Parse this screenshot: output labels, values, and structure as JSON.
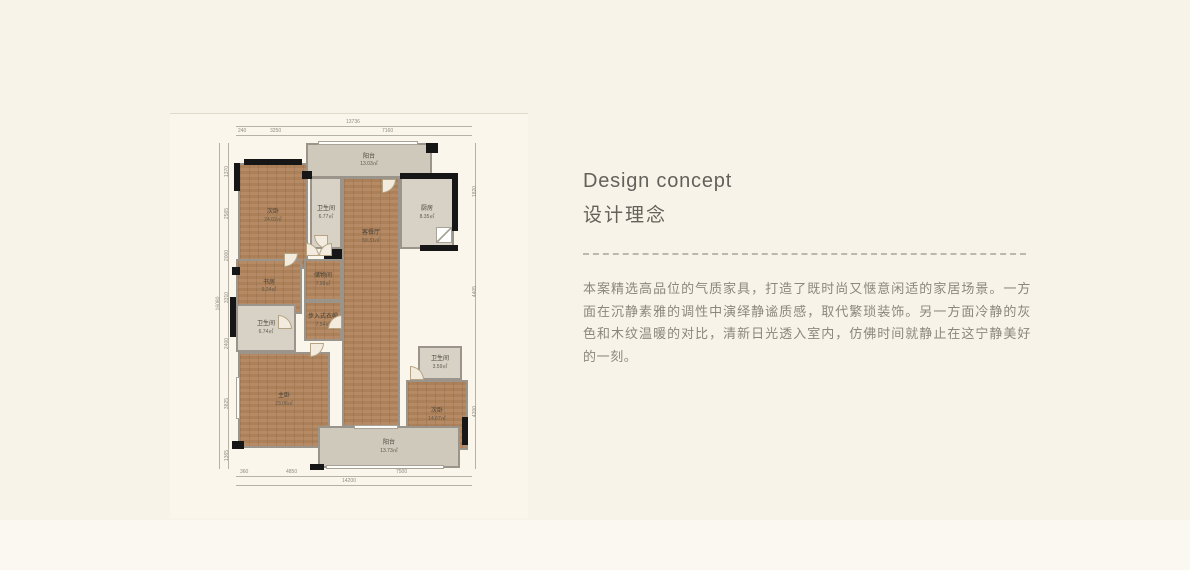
{
  "title": {
    "en": "Design concept",
    "zh": "设计理念"
  },
  "concept": {
    "text": "本案精选高品位的气质家具，打造了既时尚又惬意闲适的家居场景。一方面在沉静素雅的调性中演绎静谧质感，取代繁琐装饰。另一方面冷静的灰色和木纹温暖的对比，清新日光透入室内，仿佛时间就静止在这宁静美好的一刻。"
  },
  "colors": {
    "page_bg": "#f8f3e8",
    "wood_floor": "#b1845c",
    "tile_floor": "#d8d2c6",
    "balcony_floor": "#cfc9bb",
    "wall_black": "#161616",
    "divider": "#bdb8ab",
    "title_text": "#63615b",
    "body_text": "#8b877c"
  },
  "floorplan": {
    "rooms": [
      {
        "name": "阳台",
        "area": "13.03㎡"
      },
      {
        "name": "次卧",
        "area": "24.02㎡"
      },
      {
        "name": "卫生间",
        "area": "6.77㎡"
      },
      {
        "name": "厨房",
        "area": "8.35㎡"
      },
      {
        "name": "客餐厅",
        "area": "50.31㎡"
      },
      {
        "name": "书房",
        "area": "9.24㎡"
      },
      {
        "name": "储物间",
        "area": "7.99㎡"
      },
      {
        "name": "步入式衣帽",
        "area": "7.54㎡"
      },
      {
        "name": "卫生间",
        "area": "6.74㎡"
      },
      {
        "name": "主卧",
        "area": "23.06㎡"
      },
      {
        "name": "卫生间",
        "area": "3.59㎡"
      },
      {
        "name": "次卧",
        "area": "14.67㎡"
      },
      {
        "name": "阳台",
        "area": "13.73㎡"
      }
    ],
    "dims": {
      "top_total": "13736",
      "top_segments": [
        "240",
        "3250",
        "7160"
      ],
      "left_total": "16080",
      "left_segments": [
        "1370",
        "2565",
        "2000",
        "3310",
        "2400",
        "3825",
        "1365"
      ],
      "right_segments": [
        "1820",
        "4405",
        "4200"
      ],
      "bottom_segments": [
        "360",
        "4850",
        "7500"
      ],
      "bottom_total": "14200"
    }
  }
}
